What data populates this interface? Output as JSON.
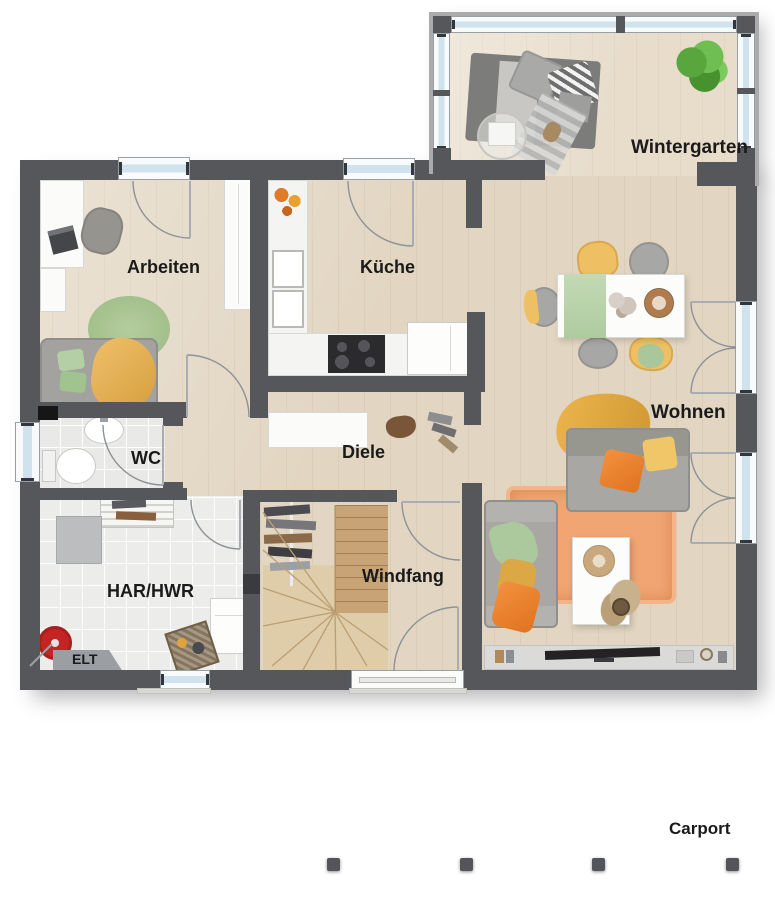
{
  "plan_title": "Erdgeschoss Grundriss",
  "labels": {
    "wintergarten": "Wintergarten",
    "arbeiten": "Arbeiten",
    "kueche": "Küche",
    "wohnen": "Wohnen",
    "wc": "WC",
    "diele": "Diele",
    "har_hwr": "HAR/HWR",
    "windfang": "Windfang",
    "elt": "ELT",
    "carport": "Carport"
  },
  "rooms": [
    {
      "id": "wintergarten",
      "label": "Wintergarten"
    },
    {
      "id": "arbeiten",
      "label": "Arbeiten"
    },
    {
      "id": "kueche",
      "label": "Küche"
    },
    {
      "id": "wohnen",
      "label": "Wohnen"
    },
    {
      "id": "wc",
      "label": "WC"
    },
    {
      "id": "diele",
      "label": "Diele"
    },
    {
      "id": "har_hwr",
      "label": "HAR/HWR"
    },
    {
      "id": "windfang",
      "label": "Windfang"
    },
    {
      "id": "elt",
      "label": "ELT"
    },
    {
      "id": "carport",
      "label": "Carport"
    }
  ],
  "palette": {
    "wall": "#55575b",
    "wood_floor": "#e2d6c2",
    "wintergarten_floor": "#e8ddcb",
    "tile_floor": "#e9e9e8",
    "window_glass": "#cfe2ee",
    "accent_orange": "#ee8530",
    "accent_yellow": "#eec063",
    "accent_green": "#a9c79b",
    "rug_orange": "#f0a573",
    "stair_wood": "#dfcda9",
    "label_text": "#1a1a1a"
  }
}
